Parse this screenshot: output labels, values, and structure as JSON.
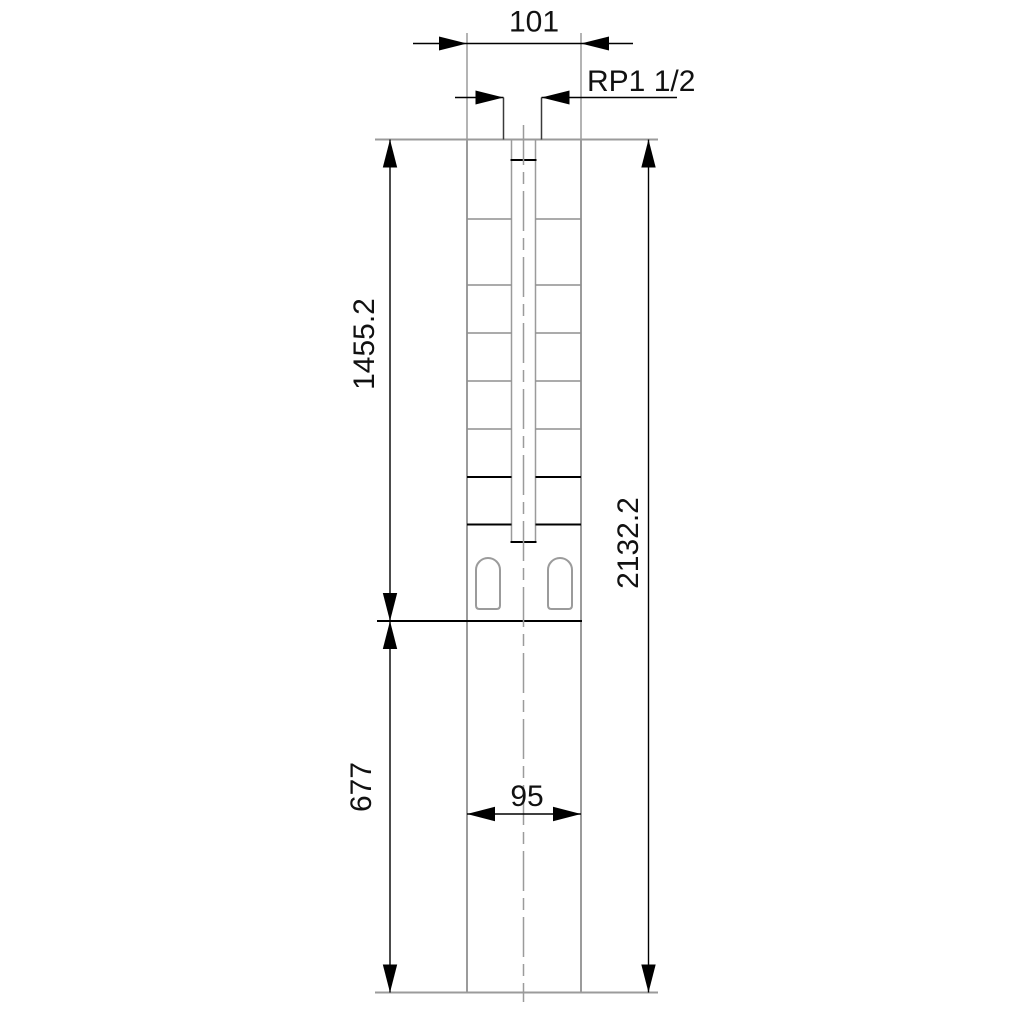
{
  "drawing": {
    "subject": "submersible-borehole-pump-outline-drawing",
    "labels": {
      "width_top": "101",
      "thread": "RP1 1/2",
      "length_pump": "1455.2",
      "length_total": "2132.2",
      "length_motor": "677",
      "width_motor": "95"
    },
    "colors": {
      "outline_gray": "#9b9b9b",
      "dimension_black": "#000000",
      "background": "#ffffff"
    }
  }
}
